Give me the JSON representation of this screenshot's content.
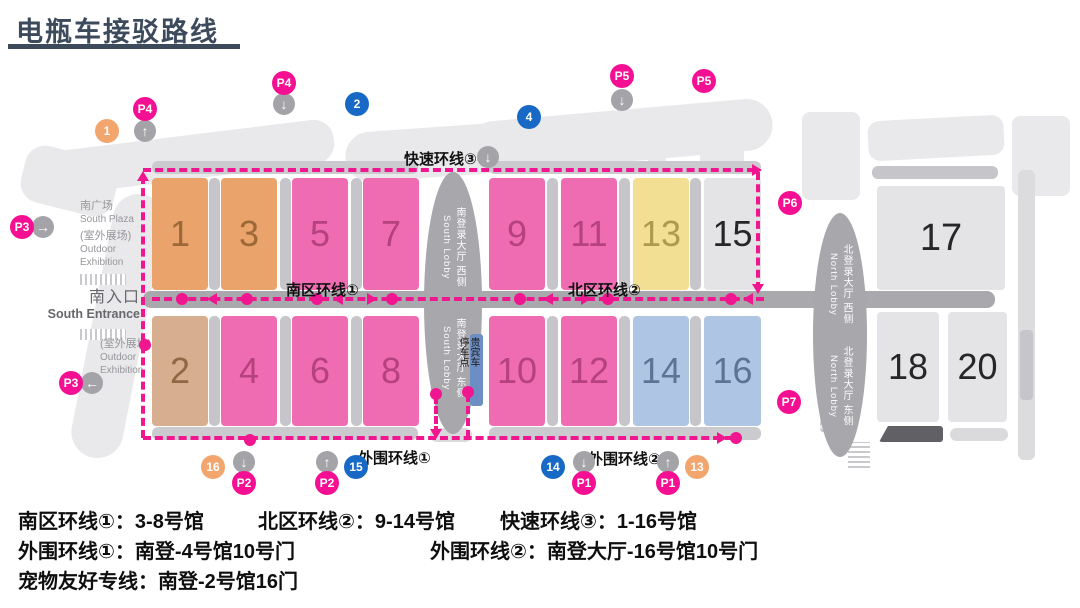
{
  "title": "电瓶车接驳路线",
  "map": {
    "route_labels": {
      "fast": "快速环线③",
      "south": "南区环线①",
      "north": "北区环线②",
      "outer1": "外围环线①",
      "outer2": "外围环线②"
    },
    "areas": {
      "south_plaza_cn": "南广场",
      "south_plaza_en": "South Plaza",
      "outdoor_cn": "(室外展场)",
      "outdoor_en1": "Outdoor",
      "outdoor_en2": "Exhibition",
      "south_entrance_cn": "南入口",
      "south_entrance_en": "South Entrance"
    },
    "lobbies": {
      "south_west_cn": "南登录大厅 西侧",
      "south_east_cn": "南登录大厅 东侧",
      "south_en": "South Lobby",
      "north_west_cn": "北登录大厅 西侧",
      "north_east_cn": "北登录大厅 东侧",
      "north_en": "North Lobby"
    },
    "vip_stop": "贵宾车停车点",
    "halls": [
      {
        "num": "1"
      },
      {
        "num": "3"
      },
      {
        "num": "5"
      },
      {
        "num": "7"
      },
      {
        "num": "9"
      },
      {
        "num": "11"
      },
      {
        "num": "13"
      },
      {
        "num": "15"
      },
      {
        "num": "2"
      },
      {
        "num": "4"
      },
      {
        "num": "6"
      },
      {
        "num": "8"
      },
      {
        "num": "10"
      },
      {
        "num": "12"
      },
      {
        "num": "14"
      },
      {
        "num": "16"
      },
      {
        "num": "17"
      },
      {
        "num": "18"
      },
      {
        "num": "20"
      }
    ],
    "badges": [
      {
        "label": "P4"
      },
      {
        "label": "P4"
      },
      {
        "label": "2"
      },
      {
        "label": "4"
      },
      {
        "label": "P5"
      },
      {
        "label": "P5"
      },
      {
        "label": "1"
      },
      {
        "label": "P3"
      },
      {
        "label": "P3"
      },
      {
        "label": "P6"
      },
      {
        "label": "P7"
      },
      {
        "label": "16"
      },
      {
        "label": "P2"
      },
      {
        "label": "P2"
      },
      {
        "label": "15"
      },
      {
        "label": "14"
      },
      {
        "label": "P1"
      },
      {
        "label": "P1"
      },
      {
        "label": "13"
      }
    ]
  },
  "icons": {
    "up": "↑",
    "down": "↓",
    "left": "←",
    "right": "→"
  },
  "legend": {
    "l1a": "南区环线①：3-8号馆",
    "l1b": "北区环线②：9-14号馆",
    "l1c": "快速环线③：1-16号馆",
    "l2a": "外围环线①：南登-4号馆10号门",
    "l2b": "外围环线②：南登大厅-16号馆10号门",
    "l3": "宠物友好专线：南登-2号馆16门"
  },
  "colors": {
    "title": "#3D4A5C",
    "route": "#F0168F",
    "badge_pink": "#F50F92",
    "badge_blue": "#1769C5",
    "badge_orange": "#F2A66E",
    "hall_orange": "#E9A36B",
    "hall_tan": "#D8AE90",
    "hall_pink": "#F06CB2",
    "hall_yellow": "#F3DF93",
    "hall_blue": "#AFC5E4",
    "hall_gray": "#E4E4E6",
    "road": "#A8A8AD",
    "vip_bar": "#6C8EC2"
  }
}
